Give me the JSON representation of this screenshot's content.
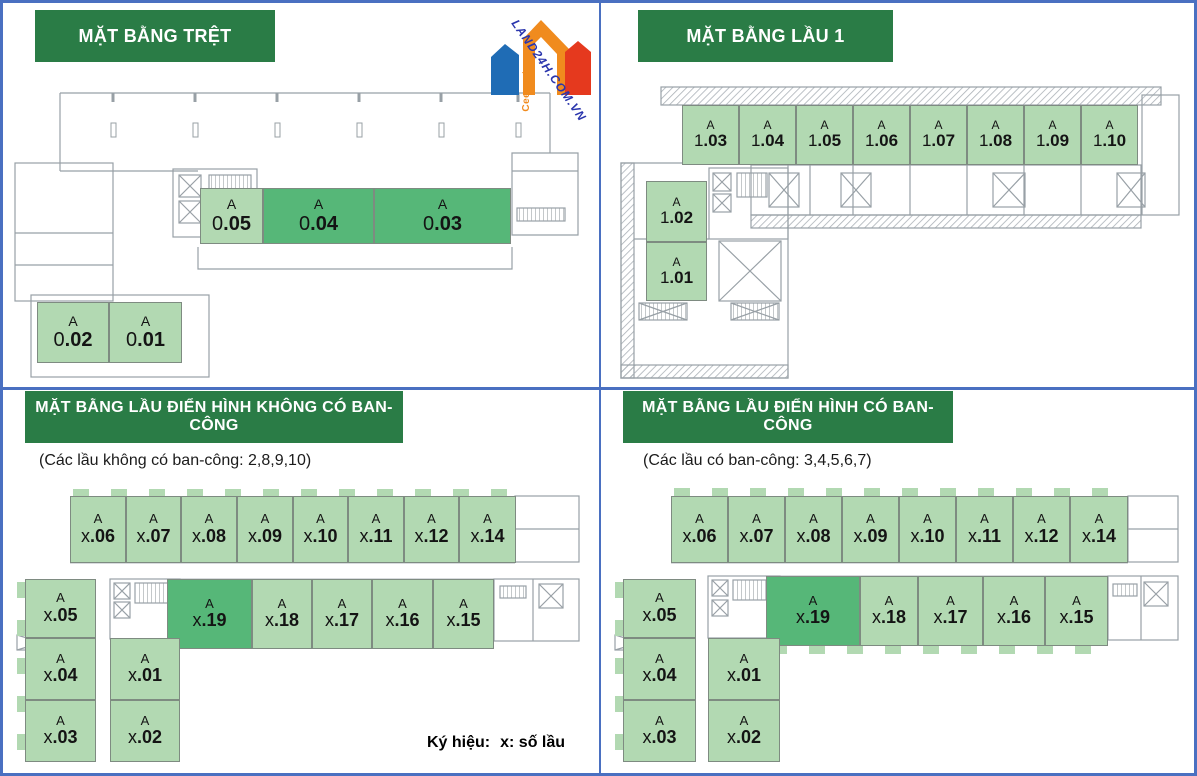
{
  "page": {
    "background": "#ffffff",
    "frame_color": "#4a70c1"
  },
  "colors": {
    "header_bg": "#2a7c46",
    "unit_light": "#b2d9b2",
    "unit_dark": "#56b778",
    "plan_line": "#98a0a6"
  },
  "logo": {
    "brand": "Ceeport",
    "watermark": "LAND24H.COM.VN",
    "colors": {
      "blue": "#1f6cb5",
      "orange": "#f08b1e",
      "red": "#e5391e",
      "watermark_text": "#2a35ad"
    }
  },
  "legend": {
    "label": "Ký hiệu:",
    "value": "x: số lầu"
  },
  "quadrants": [
    {
      "id": "ground-floor",
      "title": "MẶT BẰNG TRỆT",
      "units": [
        {
          "building": "A",
          "floor": "0",
          "num": ".05",
          "variant": "light",
          "x": 197,
          "y": 185,
          "w": 63,
          "h": 56
        },
        {
          "building": "A",
          "floor": "0",
          "num": ".04",
          "variant": "dark",
          "x": 260,
          "y": 185,
          "w": 111,
          "h": 56
        },
        {
          "building": "A",
          "floor": "0",
          "num": ".03",
          "variant": "dark",
          "x": 371,
          "y": 185,
          "w": 137,
          "h": 56
        },
        {
          "building": "A",
          "floor": "0",
          "num": ".02",
          "variant": "light",
          "x": 34,
          "y": 299,
          "w": 72,
          "h": 61
        },
        {
          "building": "A",
          "floor": "0",
          "num": ".01",
          "variant": "light",
          "x": 106,
          "y": 299,
          "w": 73,
          "h": 61
        }
      ]
    },
    {
      "id": "floor-1",
      "title": "MẶT BẰNG LẦU 1",
      "units": [
        {
          "building": "A",
          "floor": "1",
          "num": ".03",
          "variant": "light",
          "x": 81,
          "y": 102,
          "w": 57,
          "h": 60
        },
        {
          "building": "A",
          "floor": "1",
          "num": ".04",
          "variant": "light",
          "x": 138,
          "y": 102,
          "w": 57,
          "h": 60
        },
        {
          "building": "A",
          "floor": "1",
          "num": ".05",
          "variant": "light",
          "x": 195,
          "y": 102,
          "w": 57,
          "h": 60
        },
        {
          "building": "A",
          "floor": "1",
          "num": ".06",
          "variant": "light",
          "x": 252,
          "y": 102,
          "w": 57,
          "h": 60
        },
        {
          "building": "A",
          "floor": "1",
          "num": ".07",
          "variant": "light",
          "x": 309,
          "y": 102,
          "w": 57,
          "h": 60
        },
        {
          "building": "A",
          "floor": "1",
          "num": ".08",
          "variant": "light",
          "x": 366,
          "y": 102,
          "w": 57,
          "h": 60
        },
        {
          "building": "A",
          "floor": "1",
          "num": ".09",
          "variant": "light",
          "x": 423,
          "y": 102,
          "w": 57,
          "h": 60
        },
        {
          "building": "A",
          "floor": "1",
          "num": ".10",
          "variant": "light",
          "x": 480,
          "y": 102,
          "w": 57,
          "h": 60
        },
        {
          "building": "A",
          "floor": "1",
          "num": ".02",
          "variant": "light",
          "x": 45,
          "y": 178,
          "w": 61,
          "h": 61
        },
        {
          "building": "A",
          "floor": "1",
          "num": ".01",
          "variant": "light",
          "x": 45,
          "y": 239,
          "w": 61,
          "h": 59
        }
      ]
    },
    {
      "id": "typical-no-balcony",
      "title": "MẶT BẰNG LẦU ĐIỂN HÌNH KHÔNG CÓ BAN-CÔNG",
      "note": "(Các lầu không có ban-công: 2,8,9,10)",
      "units": [
        {
          "building": "A",
          "floor": "x",
          "num": ".06",
          "variant": "light",
          "x": 67,
          "y": 106,
          "w": 56,
          "h": 67
        },
        {
          "building": "A",
          "floor": "x",
          "num": ".07",
          "variant": "light",
          "x": 123,
          "y": 106,
          "w": 55,
          "h": 67
        },
        {
          "building": "A",
          "floor": "x",
          "num": ".08",
          "variant": "light",
          "x": 178,
          "y": 106,
          "w": 56,
          "h": 67
        },
        {
          "building": "A",
          "floor": "x",
          "num": ".09",
          "variant": "light",
          "x": 234,
          "y": 106,
          "w": 56,
          "h": 67
        },
        {
          "building": "A",
          "floor": "x",
          "num": ".10",
          "variant": "light",
          "x": 290,
          "y": 106,
          "w": 55,
          "h": 67
        },
        {
          "building": "A",
          "floor": "x",
          "num": ".11",
          "variant": "light",
          "x": 345,
          "y": 106,
          "w": 56,
          "h": 67
        },
        {
          "building": "A",
          "floor": "x",
          "num": ".12",
          "variant": "light",
          "x": 401,
          "y": 106,
          "w": 55,
          "h": 67
        },
        {
          "building": "A",
          "floor": "x",
          "num": ".14",
          "variant": "light",
          "x": 456,
          "y": 106,
          "w": 57,
          "h": 67
        },
        {
          "building": "A",
          "floor": "x",
          "num": ".19",
          "variant": "dark",
          "x": 164,
          "y": 189,
          "w": 85,
          "h": 70
        },
        {
          "building": "A",
          "floor": "x",
          "num": ".18",
          "variant": "light",
          "x": 249,
          "y": 189,
          "w": 60,
          "h": 70
        },
        {
          "building": "A",
          "floor": "x",
          "num": ".17",
          "variant": "light",
          "x": 309,
          "y": 189,
          "w": 60,
          "h": 70
        },
        {
          "building": "A",
          "floor": "x",
          "num": ".16",
          "variant": "light",
          "x": 369,
          "y": 189,
          "w": 61,
          "h": 70
        },
        {
          "building": "A",
          "floor": "x",
          "num": ".15",
          "variant": "light",
          "x": 430,
          "y": 189,
          "w": 61,
          "h": 70
        },
        {
          "building": "A",
          "floor": "x",
          "num": ".05",
          "variant": "light",
          "x": 22,
          "y": 189,
          "w": 71,
          "h": 59
        },
        {
          "building": "A",
          "floor": "x",
          "num": ".04",
          "variant": "light",
          "x": 22,
          "y": 248,
          "w": 71,
          "h": 62
        },
        {
          "building": "A",
          "floor": "x",
          "num": ".03",
          "variant": "light",
          "x": 22,
          "y": 310,
          "w": 71,
          "h": 62
        },
        {
          "building": "A",
          "floor": "x",
          "num": ".01",
          "variant": "light",
          "x": 107,
          "y": 248,
          "w": 70,
          "h": 62
        },
        {
          "building": "A",
          "floor": "x",
          "num": ".02",
          "variant": "light",
          "x": 107,
          "y": 310,
          "w": 70,
          "h": 62
        }
      ]
    },
    {
      "id": "typical-balcony",
      "title": "MẶT BẰNG LẦU ĐIỂN HÌNH CÓ BAN-CÔNG",
      "note": "(Các lầu có ban-công: 3,4,5,6,7)",
      "units": [
        {
          "building": "A",
          "floor": "x",
          "num": ".06",
          "variant": "light",
          "x": 70,
          "y": 106,
          "w": 57,
          "h": 67
        },
        {
          "building": "A",
          "floor": "x",
          "num": ".07",
          "variant": "light",
          "x": 127,
          "y": 106,
          "w": 57,
          "h": 67
        },
        {
          "building": "A",
          "floor": "x",
          "num": ".08",
          "variant": "light",
          "x": 184,
          "y": 106,
          "w": 57,
          "h": 67
        },
        {
          "building": "A",
          "floor": "x",
          "num": ".09",
          "variant": "light",
          "x": 241,
          "y": 106,
          "w": 57,
          "h": 67
        },
        {
          "building": "A",
          "floor": "x",
          "num": ".10",
          "variant": "light",
          "x": 298,
          "y": 106,
          "w": 57,
          "h": 67
        },
        {
          "building": "A",
          "floor": "x",
          "num": ".11",
          "variant": "light",
          "x": 355,
          "y": 106,
          "w": 57,
          "h": 67
        },
        {
          "building": "A",
          "floor": "x",
          "num": ".12",
          "variant": "light",
          "x": 412,
          "y": 106,
          "w": 57,
          "h": 67
        },
        {
          "building": "A",
          "floor": "x",
          "num": ".14",
          "variant": "light",
          "x": 469,
          "y": 106,
          "w": 58,
          "h": 67
        },
        {
          "building": "A",
          "floor": "x",
          "num": ".19",
          "variant": "dark",
          "x": 165,
          "y": 186,
          "w": 94,
          "h": 70
        },
        {
          "building": "A",
          "floor": "x",
          "num": ".18",
          "variant": "light",
          "x": 259,
          "y": 186,
          "w": 58,
          "h": 70
        },
        {
          "building": "A",
          "floor": "x",
          "num": ".17",
          "variant": "light",
          "x": 317,
          "y": 186,
          "w": 65,
          "h": 70
        },
        {
          "building": "A",
          "floor": "x",
          "num": ".16",
          "variant": "light",
          "x": 382,
          "y": 186,
          "w": 62,
          "h": 70
        },
        {
          "building": "A",
          "floor": "x",
          "num": ".15",
          "variant": "light",
          "x": 444,
          "y": 186,
          "w": 63,
          "h": 70
        },
        {
          "building": "A",
          "floor": "x",
          "num": ".05",
          "variant": "light",
          "x": 22,
          "y": 189,
          "w": 73,
          "h": 59
        },
        {
          "building": "A",
          "floor": "x",
          "num": ".04",
          "variant": "light",
          "x": 22,
          "y": 248,
          "w": 73,
          "h": 62
        },
        {
          "building": "A",
          "floor": "x",
          "num": ".03",
          "variant": "light",
          "x": 22,
          "y": 310,
          "w": 73,
          "h": 62
        },
        {
          "building": "A",
          "floor": "x",
          "num": ".01",
          "variant": "light",
          "x": 107,
          "y": 248,
          "w": 72,
          "h": 62
        },
        {
          "building": "A",
          "floor": "x",
          "num": ".02",
          "variant": "light",
          "x": 107,
          "y": 310,
          "w": 72,
          "h": 62
        }
      ]
    }
  ]
}
